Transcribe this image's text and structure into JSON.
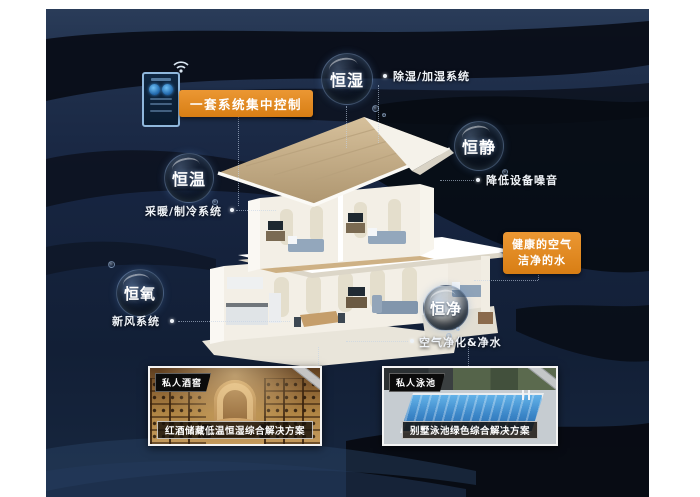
{
  "colors": {
    "background": "#FFFFFF",
    "canvas_navy": "#16243C",
    "swoosh_black": "#0A0F18",
    "accent_orange": "#DE851F",
    "pool_blue": "#2E77BC",
    "wine_wood": "#B08544"
  },
  "control": {
    "label": "一套系统集中控制"
  },
  "highlight": {
    "line1": "健康的空气",
    "line2": "洁净的水"
  },
  "features": [
    {
      "bubble": "恒湿",
      "label": "除湿/加湿系统"
    },
    {
      "bubble": "恒静",
      "label": "降低设备噪音"
    },
    {
      "bubble": "恒温",
      "label": "采暖/制冷系统"
    },
    {
      "bubble": "恒氧",
      "label": "新风系统"
    },
    {
      "bubble": "恒净",
      "label": "空气净化&净水"
    }
  ],
  "cards": [
    {
      "tag": "私人酒窖",
      "caption": "红酒储藏低温恒湿综合解决方案"
    },
    {
      "tag": "私人泳池",
      "caption": "别墅泳池绿色综合解决方案"
    }
  ]
}
